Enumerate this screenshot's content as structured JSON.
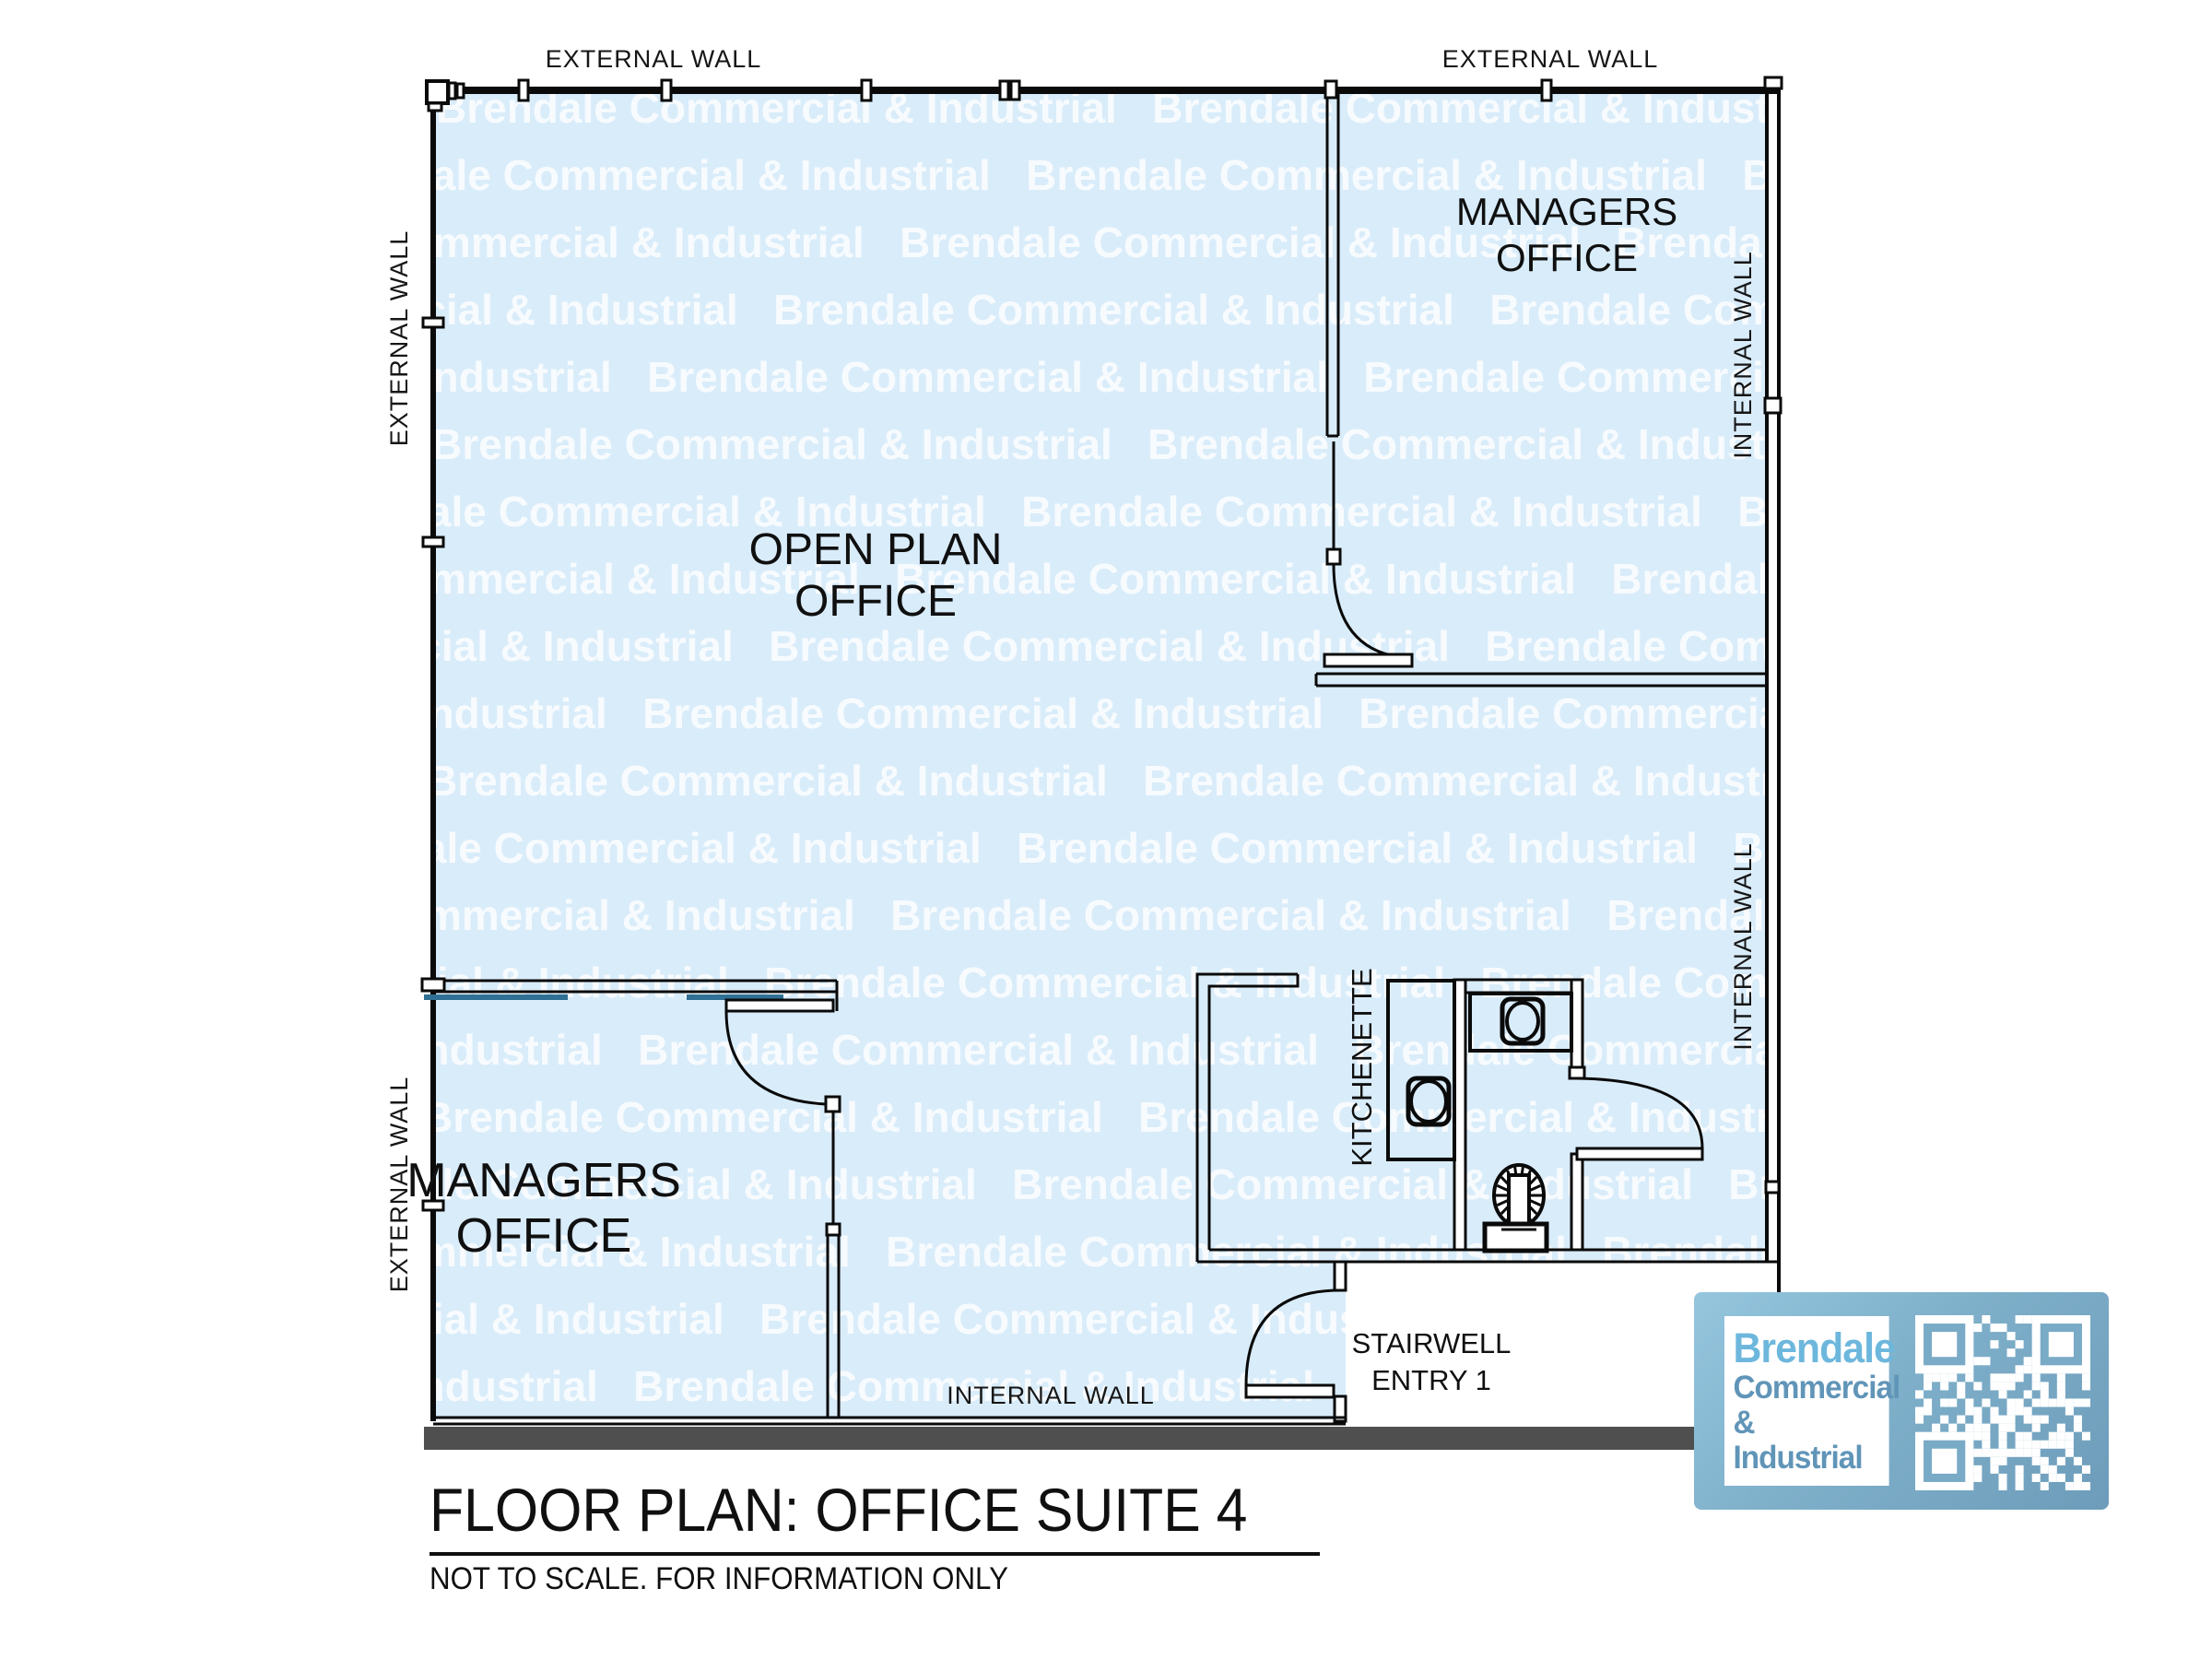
{
  "plan": {
    "watermark_text": "Brendale Commercial & Industrial",
    "labels": {
      "external_wall_top_1": "EXTERNAL WALL",
      "external_wall_top_2": "EXTERNAL WALL",
      "external_wall_left_1": "EXTERNAL WALL",
      "external_wall_left_2": "EXTERNAL WALL",
      "internal_wall_right_1": "INTERNAL WALL",
      "internal_wall_right_2": "INTERNAL WALL",
      "internal_wall_bottom": "INTERNAL WALL"
    },
    "rooms": {
      "managers_office_top": {
        "line1": "MANAGERS",
        "line2": "OFFICE"
      },
      "open_plan_office": {
        "line1": "OPEN PLAN",
        "line2": "OFFICE"
      },
      "managers_office_bottom": {
        "line1": "MANAGERS",
        "line2": "OFFICE"
      },
      "kitchenette": "KITCHENETTE",
      "stairwell": {
        "line1": "STAIRWELL",
        "line2": "ENTRY 1"
      }
    },
    "colors": {
      "floor_fill": "#d9ecfa",
      "watermark": "#ffffff",
      "wall_line": "#0a0a0a",
      "glazing_line": "#2f7094",
      "footing_bar": "#4f4f4f",
      "stairwell_floor": "#ffffff"
    }
  },
  "title_block": {
    "title": "FLOOR PLAN: OFFICE SUITE 4",
    "subtitle": "NOT TO SCALE. FOR INFORMATION ONLY"
  },
  "logo": {
    "line1": "Brendale",
    "line2": "Commercial",
    "line3": "& Industrial",
    "qr_alt": "qr-code"
  }
}
